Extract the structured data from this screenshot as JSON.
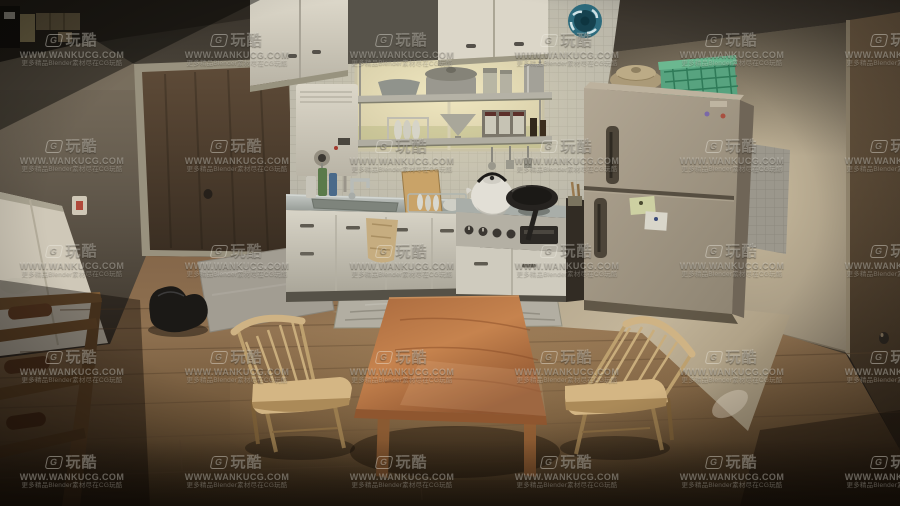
{
  "image": {
    "width": 900,
    "height": 506,
    "kind": "3d-interior-render",
    "description": "Small Japanese apartment kitchen and dining area seen from a high angle"
  },
  "watermark": {
    "logo_g": "G",
    "logo_text": "玩酷",
    "url": "WWW.WANKUCG.COM",
    "tagline": "更多精品Blender素材尽在CG玩酷",
    "color": "#f0eee4",
    "opacity": 0.34,
    "grid": {
      "col_centers_px": [
        72,
        237,
        402,
        567,
        732,
        897
      ],
      "row_tops_px": [
        33,
        139,
        244,
        350,
        455
      ]
    }
  },
  "scene": {
    "room": "kitchen-dining room",
    "objects": [
      {
        "name": "ceiling",
        "color": "#443e35"
      },
      {
        "name": "entry-door",
        "color": "#52412f"
      },
      {
        "name": "door-knob",
        "color": "#2e2820"
      },
      {
        "name": "doorbell-plate",
        "color": "#cfc7b6"
      },
      {
        "name": "left-wall",
        "color": "#91email8577"
      },
      {
        "name": "white-closet-panel",
        "color": "#cfc8b8"
      },
      {
        "name": "electrical-panel",
        "color": "#b3a274"
      },
      {
        "name": "shoe-rack",
        "color": "#6b4c2c"
      },
      {
        "name": "shoes",
        "color": "#5c3a20"
      },
      {
        "name": "backpack",
        "color": "#1b1916"
      },
      {
        "name": "entry-mat",
        "color": "#a29d92"
      },
      {
        "name": "tiled-wall",
        "color": "#b7b4a8"
      },
      {
        "name": "window",
        "color": "#ece3bd"
      },
      {
        "name": "exhaust-fan",
        "color": "#2d6b7d"
      },
      {
        "name": "water-heater",
        "color": "#dcd8cb"
      },
      {
        "name": "upper-cabinets",
        "color": "#d9d4c6"
      },
      {
        "name": "shelf-cookware",
        "color": "#9a988f"
      },
      {
        "name": "sink-counter",
        "color": "#9aa09e"
      },
      {
        "name": "lower-cabinets",
        "color": "#d2cec1"
      },
      {
        "name": "hand-towel",
        "color": "#c6ad80"
      },
      {
        "name": "gas-stove",
        "color": "#b4b0a4"
      },
      {
        "name": "kettle",
        "color": "#e2dfd6"
      },
      {
        "name": "frying-pan",
        "color": "#262320"
      },
      {
        "name": "refrigerator",
        "color": "#a69b88"
      },
      {
        "name": "fridge-notes",
        "color": "#d9d6ca"
      },
      {
        "name": "clay-pot",
        "color": "#ab9a78"
      },
      {
        "name": "laundry-basket",
        "color": "#57a37f"
      },
      {
        "name": "right-wall",
        "color": "#c0b297"
      },
      {
        "name": "right-door",
        "color": "#5d4c38"
      },
      {
        "name": "wall-outlet",
        "color": "#c89a8a"
      },
      {
        "name": "wrinkled-rug",
        "color": "#b2aea2"
      },
      {
        "name": "kitchen-vinyl-floor",
        "color": "#b5a88d"
      },
      {
        "name": "wood-floor",
        "color": "#8a6b48"
      },
      {
        "name": "dining-table",
        "color": "#c07d49"
      },
      {
        "name": "chair-left",
        "color": "#d4b684"
      },
      {
        "name": "chair-right",
        "color": "#d4b684"
      }
    ]
  }
}
